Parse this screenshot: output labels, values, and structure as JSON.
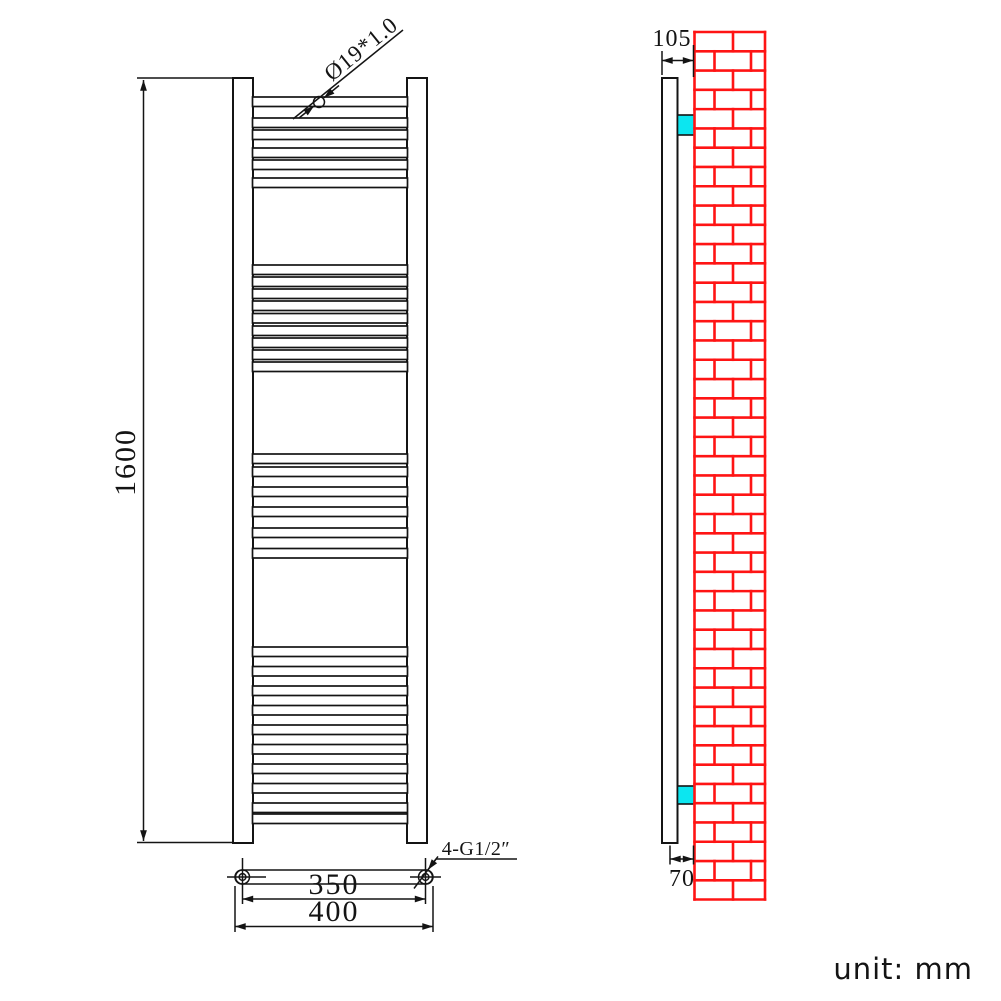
{
  "drawing": {
    "unit_note": "unit: mm",
    "front_view": {
      "tube_spec_label": "Ø19*1.0",
      "height_label": "1600",
      "center_distance_label": "350",
      "overall_width_label": "400",
      "connection_label": "4-G1/2″"
    },
    "side_view": {
      "depth_label": "105",
      "wall_offset_label": "70"
    }
  },
  "colors": {
    "line": "#141414",
    "brick_red": "#ff1414",
    "bracket_cyan": "#0ce6f0",
    "background": "#ffffff"
  }
}
